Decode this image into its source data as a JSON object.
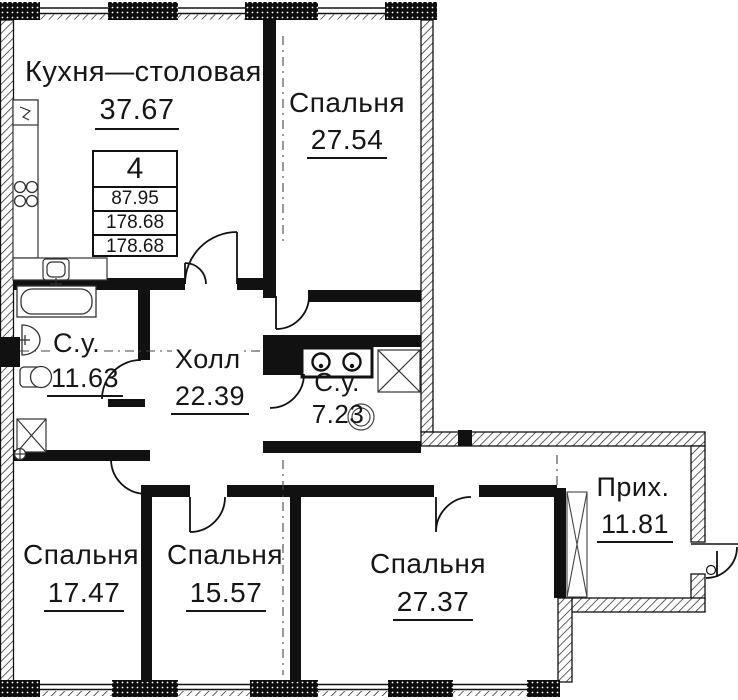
{
  "plan": {
    "type": "apartment floor plan",
    "rooms": [
      {
        "name": "Кухня—столовая",
        "area": "37.67"
      },
      {
        "name": "Спальня",
        "area": "27.54"
      },
      {
        "name": "С.у.",
        "area": "11.63"
      },
      {
        "name": "Холл",
        "area": "22.39"
      },
      {
        "name": "С.у.",
        "area": "7.23"
      },
      {
        "name": "Спальня",
        "area": "17.47"
      },
      {
        "name": "Спальня",
        "area": "15.57"
      },
      {
        "name": "Спальня",
        "area": "27.37"
      },
      {
        "name": "Прих.",
        "area": "11.81"
      }
    ],
    "stamp": {
      "rooms_count": "4",
      "rows": [
        "87.95",
        "178.68",
        "178.68"
      ]
    },
    "colors": {
      "wall": "#111111",
      "text": "#161616",
      "background": "#ffffff"
    }
  }
}
